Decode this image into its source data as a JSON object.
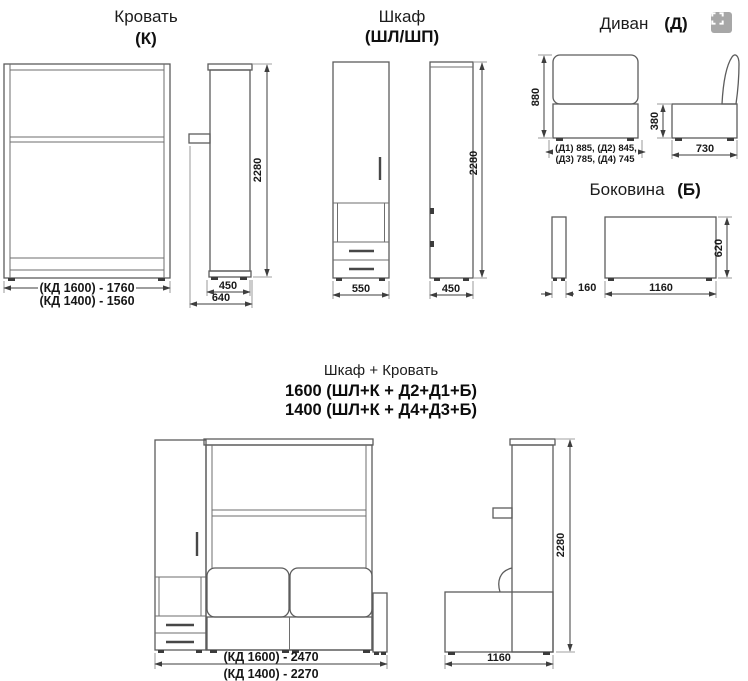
{
  "colors": {
    "background": "#ffffff",
    "outline": "#5c5c5c",
    "dimension": "#3e3e3e",
    "text": "#1a1a1a",
    "icon_bg": "#a7a7a7"
  },
  "bed": {
    "title": "Кровать",
    "subtitle": "(К)",
    "front": {
      "dim_width_1600": "(КД 1600) - 1760",
      "dim_width_1400": "(КД 1400) - 1560"
    },
    "side": {
      "dim_depth": "450",
      "dim_depth_total": "640",
      "dim_height": "2280"
    }
  },
  "wardrobe": {
    "title": "Шкаф",
    "subtitle": "(ШЛ/ШП)",
    "front": {
      "dim_width": "550"
    },
    "side": {
      "dim_depth": "450",
      "dim_height": "2280"
    }
  },
  "sofa": {
    "title": "Диван",
    "subtitle": "(Д)",
    "front": {
      "dim_height": "880",
      "dim_widths_line1": "(Д1) 885, (Д2) 845,",
      "dim_widths_line2": "(Д3) 785, (Д4) 745"
    },
    "side": {
      "dim_seat_height": "380",
      "dim_depth": "730"
    }
  },
  "side_panel": {
    "title": "Боковина",
    "subtitle": "(Б)",
    "dims": {
      "thickness": "160",
      "length": "1160",
      "height": "620"
    }
  },
  "combo": {
    "title": "Шкаф + Кровать",
    "variant_1600": "1600 (ШЛ+К + Д2+Д1+Б)",
    "variant_1400": "1400 (ШЛ+К + Д4+Д3+Б)",
    "front": {
      "dim_width_1600": "(КД 1600) - 2470",
      "dim_width_1400": "(КД 1400) - 2270"
    },
    "side": {
      "dim_depth": "1160",
      "dim_height": "2280"
    }
  }
}
